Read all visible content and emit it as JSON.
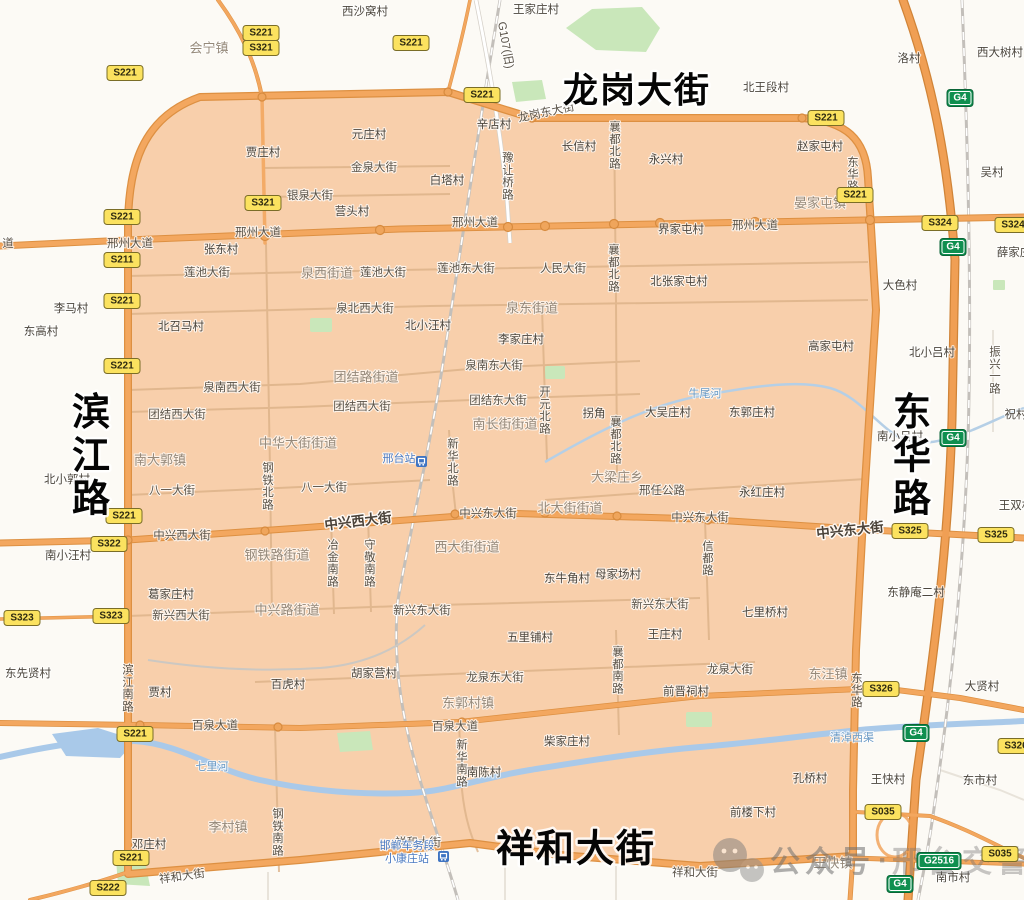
{
  "colors": {
    "background": "#fcfaf5",
    "zone_fill": "#f8cfab",
    "zone_border": "#e89552",
    "road_orange": "#f3a75f",
    "road_orange_casing": "#dd9042",
    "minor_road": "#dcb288",
    "river_blue": "#a9c9e9",
    "park_green": "#c9e7ba",
    "railway_gray": "#c3bfba",
    "shield_yellow": "#fbe25f",
    "shield_green": "#0f8f4f",
    "station_blue": "#3f74c2",
    "big_label_black": "#050505"
  },
  "big_labels": [
    {
      "text": "龙岗大街",
      "x": 637,
      "y": 90,
      "orient": "h",
      "fs": 35
    },
    {
      "text": "滨江路",
      "x": 92,
      "y": 455,
      "orient": "v",
      "fs": 38
    },
    {
      "text": "东华路",
      "x": 913,
      "y": 455,
      "orient": "v",
      "fs": 38
    },
    {
      "text": "祥和大街",
      "x": 576,
      "y": 848,
      "orient": "h",
      "fs": 38
    }
  ],
  "road_labels": [
    {
      "text": "龙岗东大街",
      "x": 546,
      "y": 112,
      "rot": -12
    },
    {
      "text": "G107(旧)",
      "x": 506,
      "y": 45,
      "rot": 80
    },
    {
      "text": "金泉大街",
      "x": 374,
      "y": 167
    },
    {
      "text": "银泉大街",
      "x": 310,
      "y": 195
    },
    {
      "text": "道",
      "x": 8,
      "y": 243
    },
    {
      "text": "邢州大道",
      "x": 130,
      "y": 243
    },
    {
      "text": "邢州大道",
      "x": 258,
      "y": 232
    },
    {
      "text": "邢州大道",
      "x": 475,
      "y": 222
    },
    {
      "text": "邢州大道",
      "x": 755,
      "y": 225
    },
    {
      "text": "豫让桥路",
      "x": 508,
      "y": 176,
      "orient": "v"
    },
    {
      "text": "襄都北路",
      "x": 615,
      "y": 145,
      "orient": "v"
    },
    {
      "text": "莲池大街",
      "x": 207,
      "y": 272
    },
    {
      "text": "莲池大街",
      "x": 383,
      "y": 272
    },
    {
      "text": "莲池东大街",
      "x": 466,
      "y": 268
    },
    {
      "text": "人民大街",
      "x": 563,
      "y": 268
    },
    {
      "text": "襄都北路",
      "x": 614,
      "y": 268,
      "orient": "v"
    },
    {
      "text": "泉北西大街",
      "x": 365,
      "y": 308
    },
    {
      "text": "泉南西大街",
      "x": 232,
      "y": 387
    },
    {
      "text": "泉南东大街",
      "x": 494,
      "y": 365
    },
    {
      "text": "团结西大街",
      "x": 177,
      "y": 414
    },
    {
      "text": "团结西大街",
      "x": 362,
      "y": 406
    },
    {
      "text": "团结东大街",
      "x": 498,
      "y": 400
    },
    {
      "text": "开元北路",
      "x": 545,
      "y": 410,
      "orient": "v"
    },
    {
      "text": "八一大街",
      "x": 172,
      "y": 490
    },
    {
      "text": "八一大街",
      "x": 324,
      "y": 487
    },
    {
      "text": "钢铁北路",
      "x": 268,
      "y": 486,
      "orient": "v"
    },
    {
      "text": "新华北路",
      "x": 453,
      "y": 462,
      "orient": "v"
    },
    {
      "text": "襄都北路",
      "x": 616,
      "y": 440,
      "orient": "v"
    },
    {
      "text": "邢任公路",
      "x": 662,
      "y": 490
    },
    {
      "text": "邢任公路",
      "x": 658,
      "y": 490,
      "hidden": true
    },
    {
      "text": "中兴西大街",
      "x": 182,
      "y": 535
    },
    {
      "text": "中兴西大街",
      "x": 358,
      "y": 521,
      "rot": -7,
      "major": true
    },
    {
      "text": "中兴东大街",
      "x": 488,
      "y": 513
    },
    {
      "text": "中兴东大街",
      "x": 700,
      "y": 517
    },
    {
      "text": "中兴东大街",
      "x": 850,
      "y": 530,
      "rot": -6,
      "major": true
    },
    {
      "text": "冶金南路",
      "x": 333,
      "y": 563,
      "orient": "v"
    },
    {
      "text": "守敬南路",
      "x": 370,
      "y": 563,
      "orient": "v"
    },
    {
      "text": "信都路",
      "x": 708,
      "y": 558,
      "orient": "v"
    },
    {
      "text": "新兴西大街",
      "x": 181,
      "y": 615
    },
    {
      "text": "新兴东大街",
      "x": 422,
      "y": 610
    },
    {
      "text": "新兴东大街",
      "x": 660,
      "y": 604
    },
    {
      "text": "龙泉东大街",
      "x": 495,
      "y": 677
    },
    {
      "text": "龙泉大街",
      "x": 730,
      "y": 669
    },
    {
      "text": "襄都南路",
      "x": 618,
      "y": 670,
      "orient": "v"
    },
    {
      "text": "百泉大道",
      "x": 215,
      "y": 725
    },
    {
      "text": "百泉大道",
      "x": 455,
      "y": 726
    },
    {
      "text": "滨江南路",
      "x": 128,
      "y": 688,
      "orient": "v"
    },
    {
      "text": "新华南路",
      "x": 462,
      "y": 763,
      "orient": "v"
    },
    {
      "text": "钢铁南路",
      "x": 278,
      "y": 832,
      "orient": "v"
    },
    {
      "text": "东华路",
      "x": 853,
      "y": 174,
      "orient": "v"
    },
    {
      "text": "东华路",
      "x": 857,
      "y": 690,
      "orient": "v"
    },
    {
      "text": "祥和大街",
      "x": 182,
      "y": 876,
      "rot": -8
    },
    {
      "text": "祥和大街",
      "x": 418,
      "y": 842
    },
    {
      "text": "祥和大街",
      "x": 695,
      "y": 872
    },
    {
      "text": "振兴一路",
      "x": 995,
      "y": 370,
      "orient": "v"
    }
  ],
  "district_labels": [
    {
      "text": "会宁镇",
      "x": 209,
      "y": 48
    },
    {
      "text": "泉西街道",
      "x": 327,
      "y": 273
    },
    {
      "text": "泉东街道",
      "x": 532,
      "y": 308
    },
    {
      "text": "团结路街道",
      "x": 366,
      "y": 377
    },
    {
      "text": "南长街街道",
      "x": 505,
      "y": 424
    },
    {
      "text": "中华大街街道",
      "x": 298,
      "y": 443
    },
    {
      "text": "南大郭镇",
      "x": 160,
      "y": 460
    },
    {
      "text": "北大街街道",
      "x": 570,
      "y": 508
    },
    {
      "text": "西大街街道",
      "x": 467,
      "y": 547
    },
    {
      "text": "钢铁路街道",
      "x": 277,
      "y": 555
    },
    {
      "text": "中兴路街道",
      "x": 287,
      "y": 610
    },
    {
      "text": "大梁庄乡",
      "x": 617,
      "y": 477
    },
    {
      "text": "晏家屯镇",
      "x": 820,
      "y": 203
    },
    {
      "text": "东郭村镇",
      "x": 468,
      "y": 703
    },
    {
      "text": "李村镇",
      "x": 228,
      "y": 827
    },
    {
      "text": "东汪镇",
      "x": 828,
      "y": 674
    },
    {
      "text": "王快镇",
      "x": 833,
      "y": 863
    }
  ],
  "village_labels": [
    {
      "text": "西沙窝村",
      "x": 365,
      "y": 11
    },
    {
      "text": "王家庄村",
      "x": 536,
      "y": 9
    },
    {
      "text": "北王段村",
      "x": 766,
      "y": 87
    },
    {
      "text": "洛村",
      "x": 909,
      "y": 58
    },
    {
      "text": "西大树村",
      "x": 1000,
      "y": 52
    },
    {
      "text": "贾庄村",
      "x": 263,
      "y": 152
    },
    {
      "text": "元庄村",
      "x": 369,
      "y": 134
    },
    {
      "text": "白塔村",
      "x": 447,
      "y": 180
    },
    {
      "text": "营头村",
      "x": 352,
      "y": 211
    },
    {
      "text": "辛店村",
      "x": 494,
      "y": 124
    },
    {
      "text": "长信村",
      "x": 579,
      "y": 146
    },
    {
      "text": "永兴村",
      "x": 666,
      "y": 159
    },
    {
      "text": "赵家屯村",
      "x": 820,
      "y": 146
    },
    {
      "text": "吴村",
      "x": 992,
      "y": 172
    },
    {
      "text": "张东村",
      "x": 221,
      "y": 249
    },
    {
      "text": "界家屯村",
      "x": 681,
      "y": 229
    },
    {
      "text": "薛家庄",
      "x": 1014,
      "y": 252
    },
    {
      "text": "李马村",
      "x": 71,
      "y": 308
    },
    {
      "text": "东高村",
      "x": 41,
      "y": 331
    },
    {
      "text": "北召马村",
      "x": 181,
      "y": 326
    },
    {
      "text": "北小汪村",
      "x": 428,
      "y": 325
    },
    {
      "text": "李家庄村",
      "x": 521,
      "y": 339
    },
    {
      "text": "北张家屯村",
      "x": 679,
      "y": 281
    },
    {
      "text": "大色村",
      "x": 900,
      "y": 285
    },
    {
      "text": "高家屯村",
      "x": 831,
      "y": 346
    },
    {
      "text": "北小吕村",
      "x": 932,
      "y": 352
    },
    {
      "text": "祝村",
      "x": 1016,
      "y": 414
    },
    {
      "text": "南小吕村",
      "x": 900,
      "y": 436
    },
    {
      "text": "拐角",
      "x": 594,
      "y": 413
    },
    {
      "text": "大吴庄村",
      "x": 668,
      "y": 412
    },
    {
      "text": "东郭庄村",
      "x": 752,
      "y": 412
    },
    {
      "text": "北小郭村",
      "x": 67,
      "y": 479
    },
    {
      "text": "南小汪村",
      "x": 68,
      "y": 555
    },
    {
      "text": "永红庄村",
      "x": 762,
      "y": 492
    },
    {
      "text": "王双村",
      "x": 1016,
      "y": 505
    },
    {
      "text": "东牛角村",
      "x": 567,
      "y": 578
    },
    {
      "text": "母家场村",
      "x": 618,
      "y": 574
    },
    {
      "text": "东静庵二村",
      "x": 916,
      "y": 592
    },
    {
      "text": "葛家庄村",
      "x": 171,
      "y": 594
    },
    {
      "text": "七里桥村",
      "x": 765,
      "y": 612
    },
    {
      "text": "王庄村",
      "x": 665,
      "y": 634
    },
    {
      "text": "五里铺村",
      "x": 530,
      "y": 637
    },
    {
      "text": "东先贤村",
      "x": 28,
      "y": 673
    },
    {
      "text": "贾村",
      "x": 160,
      "y": 692
    },
    {
      "text": "百虎村",
      "x": 288,
      "y": 684
    },
    {
      "text": "胡家营村",
      "x": 374,
      "y": 673
    },
    {
      "text": "前晋祠村",
      "x": 686,
      "y": 691
    },
    {
      "text": "大贤村",
      "x": 982,
      "y": 686
    },
    {
      "text": "柴家庄村",
      "x": 567,
      "y": 741
    },
    {
      "text": "南陈村",
      "x": 484,
      "y": 772
    },
    {
      "text": "孔桥村",
      "x": 810,
      "y": 778
    },
    {
      "text": "王快村",
      "x": 888,
      "y": 779
    },
    {
      "text": "东市村",
      "x": 980,
      "y": 780
    },
    {
      "text": "前楼下村",
      "x": 753,
      "y": 812
    },
    {
      "text": "南市村",
      "x": 953,
      "y": 877
    },
    {
      "text": "邓庄村",
      "x": 149,
      "y": 844
    }
  ],
  "river_labels": [
    {
      "text": "牛尾河",
      "x": 705,
      "y": 393
    },
    {
      "text": "七里河",
      "x": 212,
      "y": 766
    },
    {
      "text": "清淖西渠",
      "x": 852,
      "y": 737
    }
  ],
  "shields": [
    {
      "code": "S221",
      "type": "s",
      "x": 261,
      "y": 33
    },
    {
      "code": "S321",
      "type": "s",
      "x": 261,
      "y": 48
    },
    {
      "code": "S221",
      "type": "s",
      "x": 125,
      "y": 73
    },
    {
      "code": "S221",
      "type": "s",
      "x": 411,
      "y": 43
    },
    {
      "code": "S221",
      "type": "s",
      "x": 482,
      "y": 95
    },
    {
      "code": "S221",
      "type": "s",
      "x": 826,
      "y": 118
    },
    {
      "code": "S221",
      "type": "s",
      "x": 855,
      "y": 195
    },
    {
      "code": "S221",
      "type": "s",
      "x": 122,
      "y": 217
    },
    {
      "code": "S211",
      "type": "s",
      "x": 122,
      "y": 260
    },
    {
      "code": "S221",
      "type": "s",
      "x": 122,
      "y": 301
    },
    {
      "code": "S221",
      "type": "s",
      "x": 122,
      "y": 366
    },
    {
      "code": "S321",
      "type": "s",
      "x": 263,
      "y": 203
    },
    {
      "code": "S221",
      "type": "s",
      "x": 124,
      "y": 516
    },
    {
      "code": "S322",
      "type": "s",
      "x": 109,
      "y": 544
    },
    {
      "code": "S323",
      "type": "s",
      "x": 22,
      "y": 618
    },
    {
      "code": "S323",
      "type": "s",
      "x": 111,
      "y": 616
    },
    {
      "code": "S221",
      "type": "s",
      "x": 135,
      "y": 734
    },
    {
      "code": "S221",
      "type": "s",
      "x": 131,
      "y": 858
    },
    {
      "code": "S222",
      "type": "s",
      "x": 108,
      "y": 888
    },
    {
      "code": "S324",
      "type": "s",
      "x": 940,
      "y": 223
    },
    {
      "code": "S324",
      "type": "s",
      "x": 1013,
      "y": 225
    },
    {
      "code": "S325",
      "type": "s",
      "x": 910,
      "y": 531
    },
    {
      "code": "S325",
      "type": "s",
      "x": 996,
      "y": 535
    },
    {
      "code": "S326",
      "type": "s",
      "x": 881,
      "y": 689
    },
    {
      "code": "S326",
      "type": "s",
      "x": 1016,
      "y": 746
    },
    {
      "code": "S035",
      "type": "s",
      "x": 883,
      "y": 812
    },
    {
      "code": "S035",
      "type": "s",
      "x": 1000,
      "y": 854
    },
    {
      "code": "G4",
      "type": "g",
      "x": 960,
      "y": 98
    },
    {
      "code": "G4",
      "type": "g",
      "x": 953,
      "y": 247
    },
    {
      "code": "G4",
      "type": "g",
      "x": 953,
      "y": 438
    },
    {
      "code": "G4",
      "type": "g",
      "x": 916,
      "y": 733
    },
    {
      "code": "G4",
      "type": "g",
      "x": 900,
      "y": 884
    },
    {
      "code": "G2516",
      "type": "g",
      "x": 939,
      "y": 861
    }
  ],
  "stations": [
    {
      "lines": [
        "邢台站"
      ],
      "x": 399,
      "y": 462,
      "icon_x": 416,
      "icon_y": 456
    },
    {
      "lines": [
        "邯郸车务段",
        "小康庄站"
      ],
      "x": 407,
      "y": 849,
      "icon_x": 438,
      "icon_y": 851
    }
  ],
  "watermark": {
    "icon": "wechat-icon",
    "text": "公众号",
    "separator": "·",
    "text2": "邢台交警"
  }
}
